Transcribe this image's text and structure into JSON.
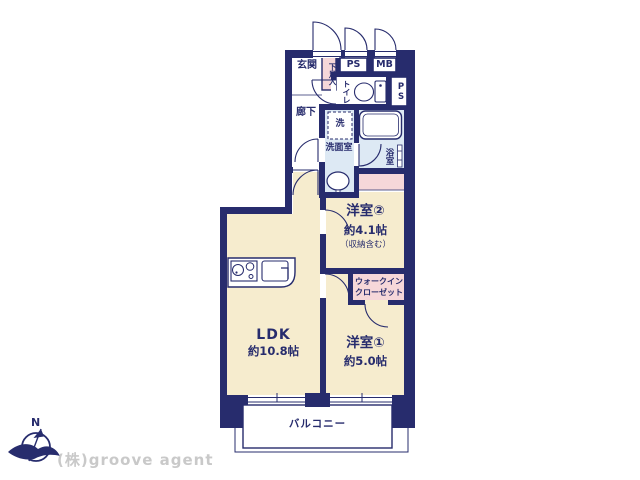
{
  "colors": {
    "wall_navy": "#272c6d",
    "room_cream": "#f6ecce",
    "room_pink": "#f6d7d9",
    "room_blue": "#dde9f4",
    "company_gray": "#c9c9c9",
    "background": "#ffffff"
  },
  "compass": {
    "north_label": "N"
  },
  "footer": {
    "company": "(株)groove agent"
  },
  "rooms": {
    "genkan": {
      "label": "玄関"
    },
    "shoe_storage": {
      "label": "下足入"
    },
    "pipe_space_top": {
      "label": "PS"
    },
    "meter_box": {
      "label": "MB"
    },
    "toilet": {
      "label": "トイレ"
    },
    "pipe_space_right": {
      "label": "PS"
    },
    "corridor": {
      "label": "廊下"
    },
    "washer_space": {
      "label": "洗"
    },
    "washroom": {
      "label": "洗面室"
    },
    "bathroom": {
      "label": "浴室"
    },
    "bedroom2": {
      "label": "洋室②",
      "size": "約4.1帖",
      "note": "（収納含む）"
    },
    "walk_in_closet": {
      "line1": "ウォークイン",
      "line2": "クローゼット"
    },
    "ldk": {
      "label": "LDK",
      "size": "約10.8帖"
    },
    "bedroom1": {
      "label": "洋室①",
      "size": "約5.0帖"
    },
    "balcony": {
      "label": "バルコニー"
    }
  }
}
